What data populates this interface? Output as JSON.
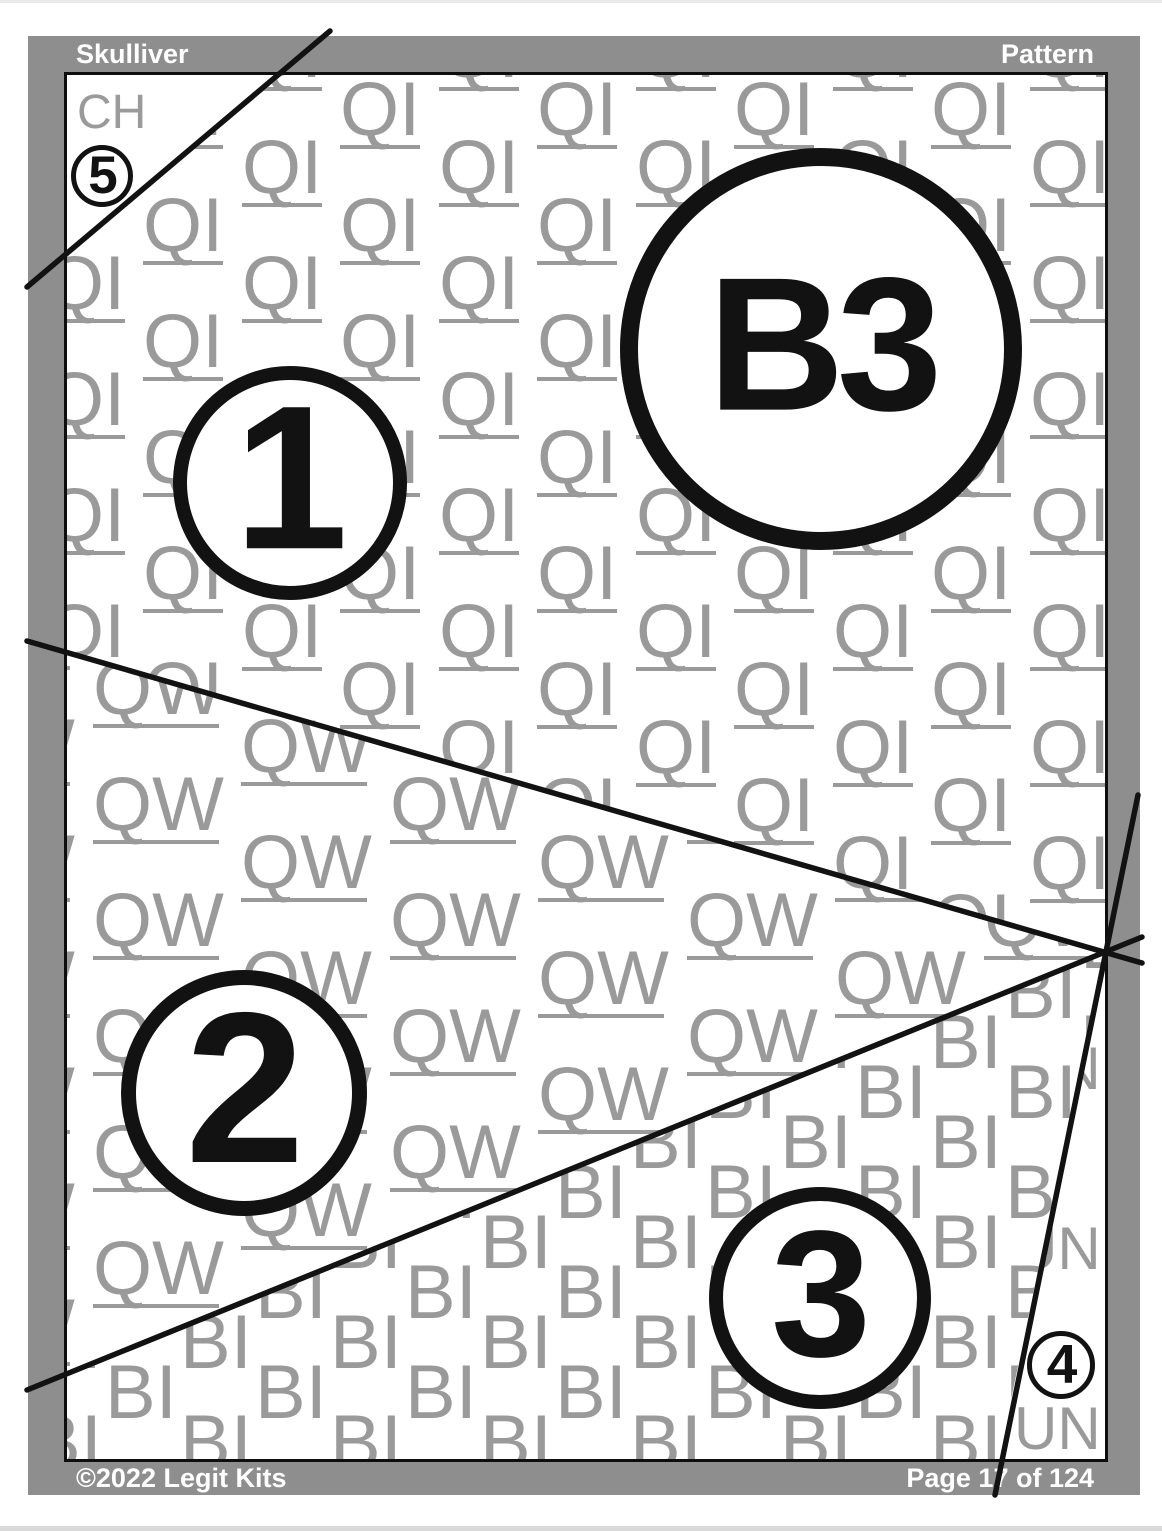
{
  "header": {
    "title_left": "Skulliver",
    "title_right": "Pattern"
  },
  "footer": {
    "copyright": "©2022 Legit Kits",
    "page_info": "Page 17 of 124"
  },
  "block": {
    "label": "B3"
  },
  "pieces": [
    {
      "number": "1",
      "fabric": "QI"
    },
    {
      "number": "2",
      "fabric": "QW"
    },
    {
      "number": "3",
      "fabric": "BI"
    },
    {
      "number": "4",
      "fabric": "UN"
    },
    {
      "number": "5",
      "fabric": "CH"
    }
  ],
  "textures": {
    "qi": "QI",
    "qw": "QW",
    "bi": "BI",
    "ch": "CH",
    "un": "UN"
  },
  "colors": {
    "frame_gray": "#8e8e8e",
    "texture_gray": "#9a9a9a",
    "line_black": "#121212",
    "page_white": "#ffffff"
  }
}
